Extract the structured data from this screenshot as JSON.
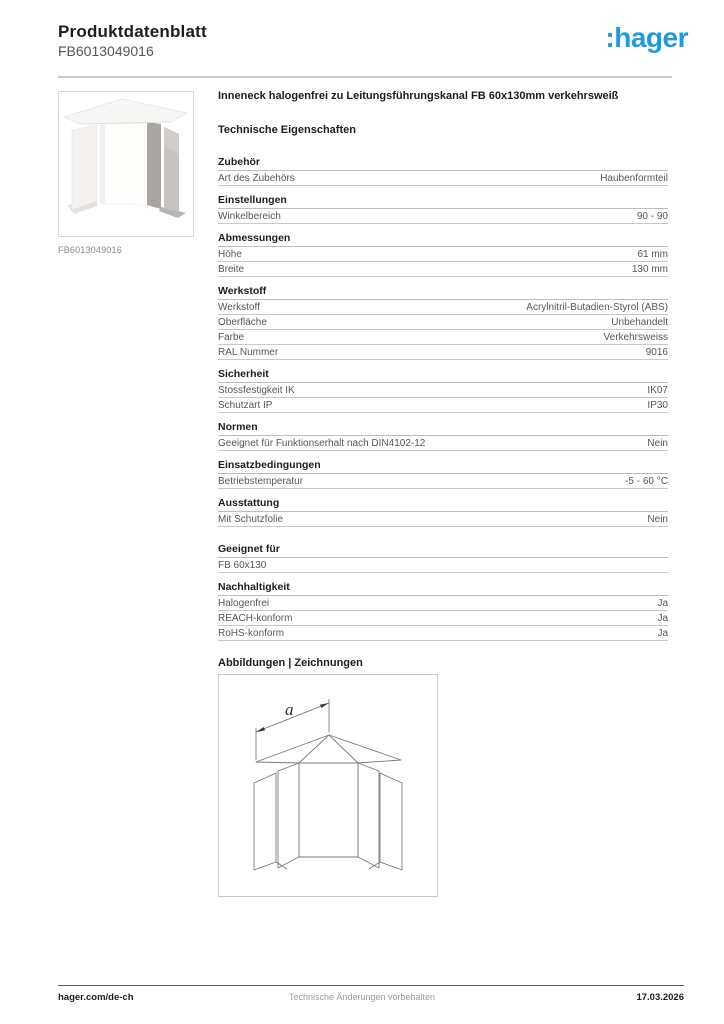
{
  "header": {
    "title": "Produktdatenblatt",
    "product_number": "FB6013049016",
    "logo_text": ":hager"
  },
  "brand": {
    "blue": "#209bd8"
  },
  "product": {
    "image_caption": "FB6013049016",
    "title": "Inneneck halogenfrei zu Leitungsführungskanal FB 60x130mm verkehrsweiß"
  },
  "table": {
    "heading": "Technische Eigenschaften",
    "sections": [
      {
        "name": "Zubehör",
        "rows": [
          [
            "Art des Zubehörs",
            "Haubenformteil"
          ]
        ]
      },
      {
        "name": "Einstellungen",
        "rows": [
          [
            "Winkelbereich",
            "90 - 90"
          ]
        ]
      },
      {
        "name": "Abmessungen",
        "rows": [
          [
            "Höhe",
            "61 mm"
          ],
          [
            "Breite",
            "130 mm"
          ]
        ]
      },
      {
        "name": "Werkstoff",
        "rows": [
          [
            "Werkstoff",
            "Acrylnitril-Butadien-Styrol (ABS)"
          ],
          [
            "Oberfläche",
            "Unbehandelt"
          ],
          [
            "Farbe",
            "Verkehrsweiss"
          ],
          [
            "RAL Nummer",
            "9016"
          ]
        ]
      },
      {
        "name": "Sicherheit",
        "rows": [
          [
            "Stossfestigkeit IK",
            "IK07"
          ],
          [
            "Schutzart IP",
            "IP30"
          ]
        ]
      },
      {
        "name": "Normen",
        "rows": [
          [
            "Geeignet für Funktionserhalt nach DIN4102-12",
            "Nein"
          ]
        ]
      },
      {
        "name": "Einsatzbedingungen",
        "rows": [
          [
            "Betriebstemperatur",
            "-5 - 60 °C"
          ]
        ]
      },
      {
        "name": "Ausstattung",
        "rows": [
          [
            "Mit Schutzfolie",
            "Nein"
          ]
        ]
      },
      {
        "name": "Geeignet für",
        "rows": [
          [
            "FB 60x130",
            ""
          ]
        ]
      },
      {
        "name": "Nachhaltigkeit",
        "rows": [
          [
            "Halogenfrei",
            "Ja"
          ],
          [
            "REACH-konform",
            "Ja"
          ],
          [
            "RoHS-konform",
            "Ja"
          ]
        ]
      }
    ]
  },
  "drawings": {
    "heading": "Abbildungen | Zeichnungen",
    "dimension_label": "a"
  },
  "footer": {
    "left": "hager.com/de-ch",
    "center": "Technische Änderungen vorbehalten",
    "right": "17.03.2026"
  }
}
